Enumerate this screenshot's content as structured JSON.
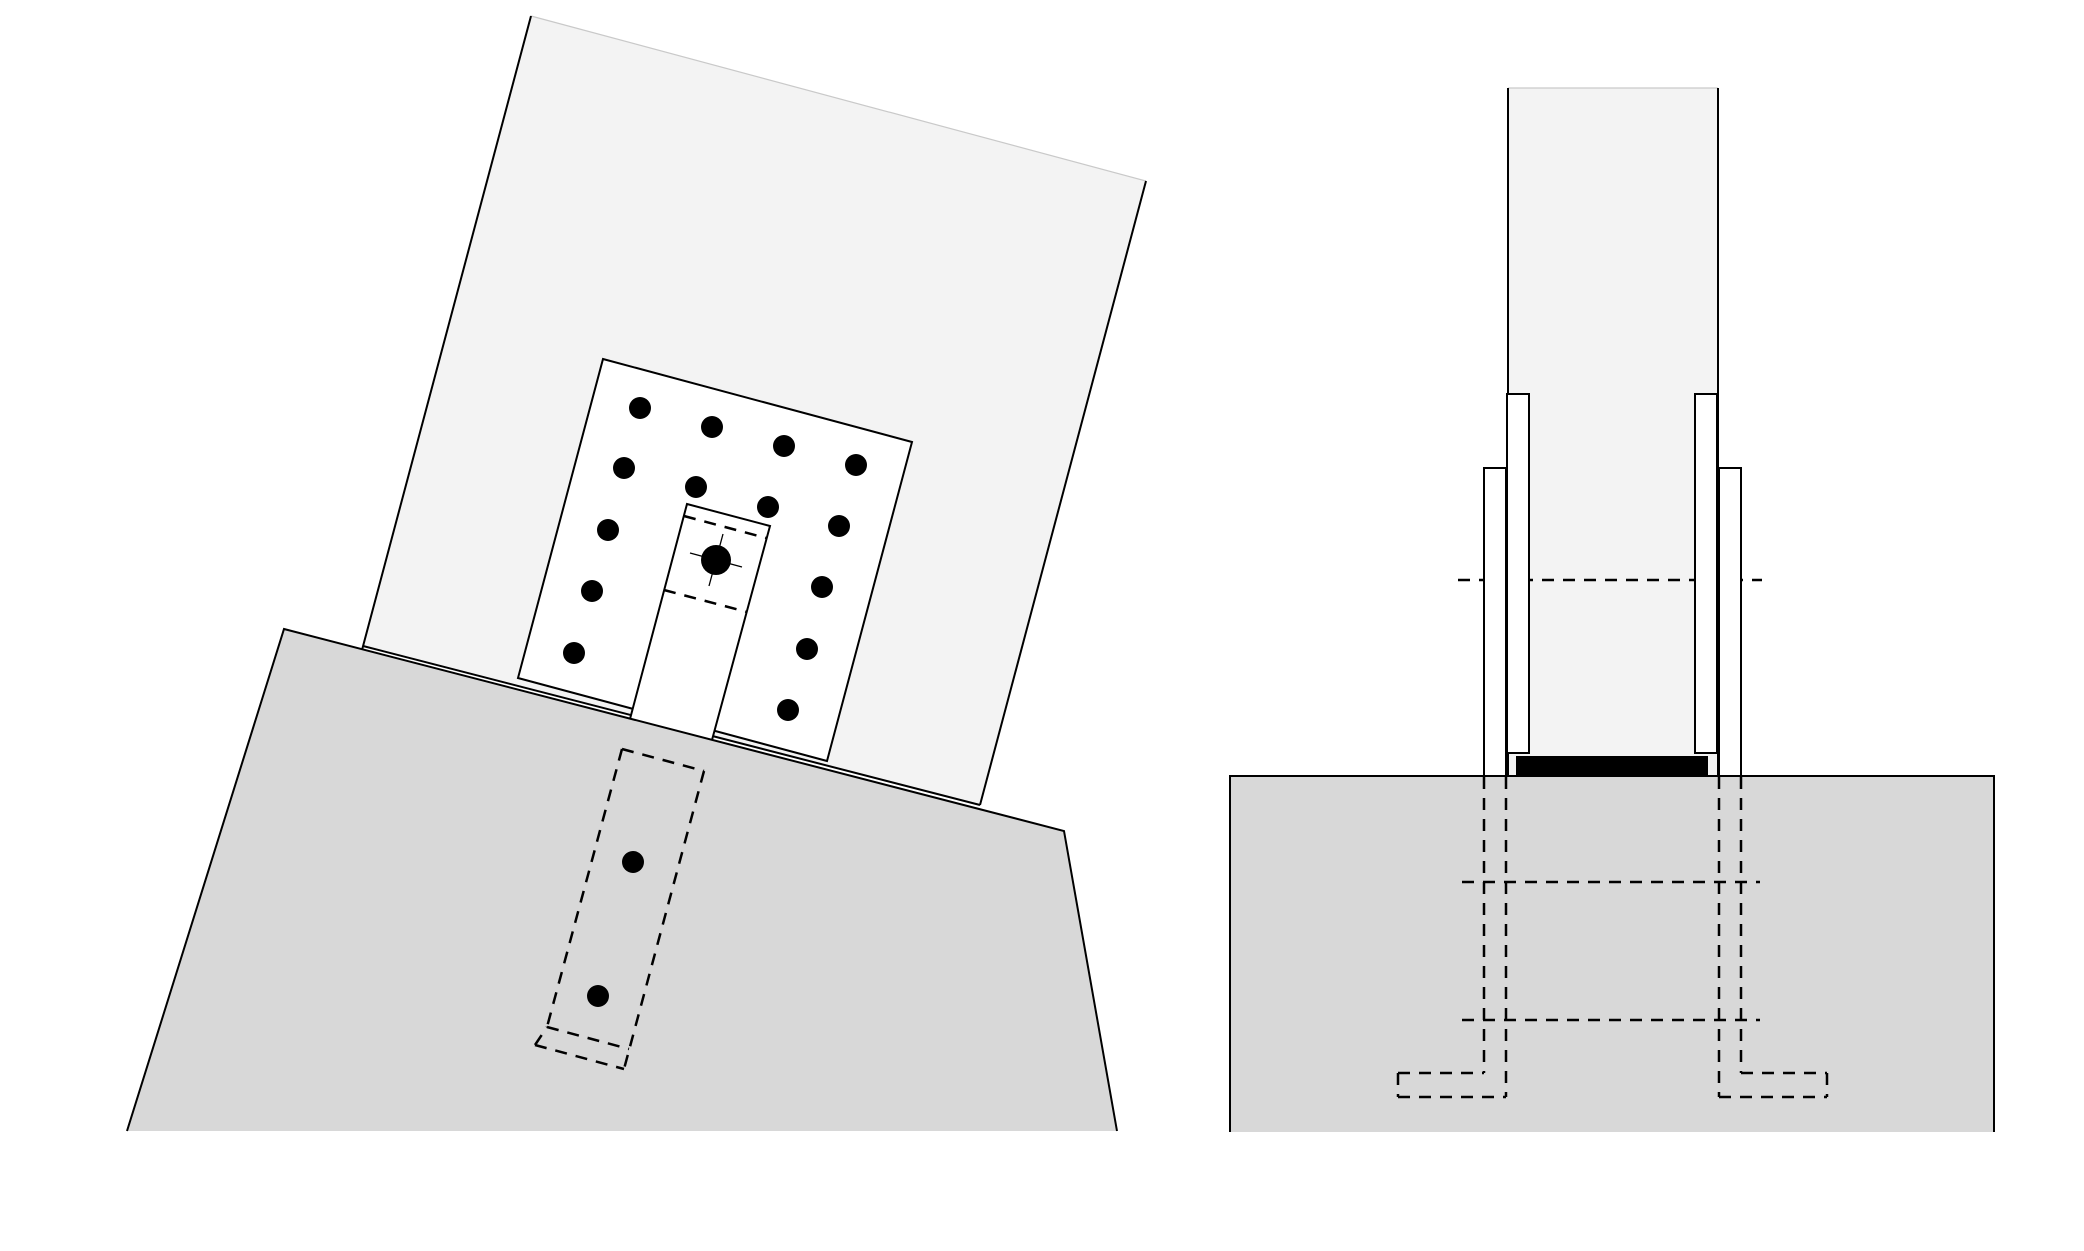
{
  "canvas": {
    "width": 2084,
    "height": 1251,
    "background": "#ffffff"
  },
  "palette": {
    "member_fill": "#f3f3f3",
    "base_fill": "#d8d8d8",
    "plate_fill": "#ffffff",
    "line": "#000000",
    "cut_edge": "#c9c9c9"
  },
  "strokes": {
    "solid_width": 2,
    "dashed_width": 2.5,
    "thin_width": 1.3,
    "cut_width": 1.2,
    "dash_pattern": "12 9"
  },
  "views": [
    {
      "name": "inclined-member-elevation-view",
      "shapes": [
        {
          "type": "polygon",
          "name": "inclined-member-fill",
          "points": [
            [
              531,
              16
            ],
            [
              1146,
              181
            ],
            [
              980,
              805
            ],
            [
              363,
              646
            ]
          ],
          "fill": "#f3f3f3"
        },
        {
          "type": "line",
          "name": "member-cut-top-edge",
          "p": [
            531,
            16,
            1146,
            181
          ],
          "stroke": "#c9c9c9",
          "w": 1.2
        },
        {
          "type": "line",
          "name": "member-left-edge",
          "p": [
            531,
            16,
            362,
            650
          ],
          "stroke": "#000000",
          "w": 2
        },
        {
          "type": "line",
          "name": "member-right-edge",
          "p": [
            1146,
            181,
            980,
            805
          ],
          "stroke": "#000000",
          "w": 2
        },
        {
          "type": "line",
          "name": "member-bottom-edge",
          "p": [
            363,
            646,
            980,
            805
          ],
          "stroke": "#000000",
          "w": 2
        },
        {
          "type": "polygon",
          "name": "connection-plate",
          "points": [
            [
              603,
              359
            ],
            [
              912,
              442
            ],
            [
              827,
              761
            ],
            [
              518,
              678
            ]
          ],
          "fill": "#ffffff",
          "stroke": "#000000",
          "w": 2
        },
        {
          "type": "polygon",
          "name": "center-slot-fill",
          "points": [
            [
              687,
              504
            ],
            [
              770,
              526
            ],
            [
              712,
              740
            ],
            [
              630,
              719
            ]
          ],
          "fill": "#ffffff"
        },
        {
          "type": "polyline",
          "name": "center-slot-outline",
          "points": [
            [
              630,
              719
            ],
            [
              687,
              504
            ],
            [
              770,
              526
            ],
            [
              712,
              740
            ]
          ],
          "stroke": "#000000",
          "w": 2
        },
        {
          "type": "line",
          "name": "slot-hidden-line-upper",
          "p": [
            684,
            516,
            766,
            538
          ],
          "stroke": "#000000",
          "w": 2.5,
          "dash": "12 9"
        },
        {
          "type": "line",
          "name": "slot-hidden-line-lower",
          "p": [
            664,
            590,
            747,
            612
          ],
          "stroke": "#000000",
          "w": 2.5,
          "dash": "12 9"
        },
        {
          "type": "line",
          "name": "main-bolt-centermark-axis-u",
          "p": [
            690,
            553,
            742,
            567
          ],
          "stroke": "#000000",
          "w": 1.3
        },
        {
          "type": "line",
          "name": "main-bolt-centermark-axis-v",
          "p": [
            723,
            534,
            709,
            586
          ],
          "stroke": "#000000",
          "w": 1.3
        },
        {
          "type": "circle",
          "name": "main-bolt-head",
          "c": [
            716,
            560
          ],
          "r": 15,
          "fill": "#000000"
        },
        {
          "type": "circle",
          "name": "plate-bolt-1",
          "c": [
            640,
            408
          ],
          "r": 11,
          "fill": "#000000"
        },
        {
          "type": "circle",
          "name": "plate-bolt-2",
          "c": [
            712,
            427
          ],
          "r": 11,
          "fill": "#000000"
        },
        {
          "type": "circle",
          "name": "plate-bolt-3",
          "c": [
            784,
            446
          ],
          "r": 11,
          "fill": "#000000"
        },
        {
          "type": "circle",
          "name": "plate-bolt-4",
          "c": [
            856,
            465
          ],
          "r": 11,
          "fill": "#000000"
        },
        {
          "type": "circle",
          "name": "plate-bolt-5",
          "c": [
            624,
            468
          ],
          "r": 11,
          "fill": "#000000"
        },
        {
          "type": "circle",
          "name": "plate-bolt-6",
          "c": [
            696,
            487
          ],
          "r": 11,
          "fill": "#000000"
        },
        {
          "type": "circle",
          "name": "plate-bolt-7",
          "c": [
            768,
            507
          ],
          "r": 11,
          "fill": "#000000"
        },
        {
          "type": "circle",
          "name": "plate-bolt-8",
          "c": [
            839,
            526
          ],
          "r": 11,
          "fill": "#000000"
        },
        {
          "type": "circle",
          "name": "plate-bolt-9",
          "c": [
            608,
            530
          ],
          "r": 11,
          "fill": "#000000"
        },
        {
          "type": "circle",
          "name": "plate-bolt-10",
          "c": [
            822,
            587
          ],
          "r": 11,
          "fill": "#000000"
        },
        {
          "type": "circle",
          "name": "plate-bolt-11",
          "c": [
            592,
            591
          ],
          "r": 11,
          "fill": "#000000"
        },
        {
          "type": "circle",
          "name": "plate-bolt-12",
          "c": [
            807,
            649
          ],
          "r": 11,
          "fill": "#000000"
        },
        {
          "type": "circle",
          "name": "plate-bolt-13",
          "c": [
            574,
            653
          ],
          "r": 11,
          "fill": "#000000"
        },
        {
          "type": "circle",
          "name": "plate-bolt-14",
          "c": [
            788,
            710
          ],
          "r": 11,
          "fill": "#000000"
        },
        {
          "type": "polygon",
          "name": "foundation-base-fill",
          "points": [
            [
              284,
              629
            ],
            [
              1064,
              831
            ],
            [
              1117,
              1131
            ],
            [
              127,
              1131
            ]
          ],
          "fill": "#d8d8d8"
        },
        {
          "type": "polyline",
          "name": "foundation-base-outline",
          "points": [
            [
              127,
              1131
            ],
            [
              284,
              629
            ],
            [
              1064,
              831
            ],
            [
              1117,
              1131
            ]
          ],
          "stroke": "#000000",
          "w": 2
        },
        {
          "type": "line",
          "name": "embedded-slot-top-hidden",
          "p": [
            622,
            749,
            704,
            771
          ],
          "stroke": "#000000",
          "w": 2.5,
          "dash": "12 9"
        },
        {
          "type": "line",
          "name": "embedded-slot-left-hidden",
          "p": [
            622,
            749,
            547,
            1027
          ],
          "stroke": "#000000",
          "w": 2.5,
          "dash": "12 9"
        },
        {
          "type": "line",
          "name": "embedded-slot-right-hidden",
          "p": [
            704,
            771,
            624,
            1069
          ],
          "stroke": "#000000",
          "w": 2.5,
          "dash": "12 9"
        },
        {
          "type": "line",
          "name": "embedded-slot-bottom-hidden",
          "p": [
            547,
            1027,
            629,
            1049
          ],
          "stroke": "#000000",
          "w": 2.5,
          "dash": "12 9"
        },
        {
          "type": "line",
          "name": "embedded-foot-bottom-hidden",
          "p": [
            535,
            1045,
            624,
            1069
          ],
          "stroke": "#000000",
          "w": 2.5,
          "dash": "12 9"
        },
        {
          "type": "line",
          "name": "embedded-foot-cap-hidden",
          "p": [
            535,
            1045,
            547,
            1027
          ],
          "stroke": "#000000",
          "w": 2.5,
          "dash": "12 9"
        },
        {
          "type": "circle",
          "name": "anchor-bolt-upper",
          "c": [
            633,
            862
          ],
          "r": 11,
          "fill": "#000000"
        },
        {
          "type": "circle",
          "name": "anchor-bolt-lower",
          "c": [
            598,
            996
          ],
          "r": 11,
          "fill": "#000000"
        }
      ]
    },
    {
      "name": "column-base-front-view",
      "shapes": [
        {
          "type": "rect",
          "name": "column-fill",
          "xywh": [
            1508,
            88,
            210,
            688
          ],
          "fill": "#f3f3f3"
        },
        {
          "type": "line",
          "name": "column-cut-top-edge",
          "p": [
            1508,
            88,
            1718,
            88
          ],
          "stroke": "#c9c9c9",
          "w": 1.2
        },
        {
          "type": "line",
          "name": "column-left-edge",
          "p": [
            1508,
            88,
            1508,
            776
          ],
          "stroke": "#000000",
          "w": 2
        },
        {
          "type": "line",
          "name": "column-right-edge",
          "p": [
            1718,
            88,
            1718,
            776
          ],
          "stroke": "#000000",
          "w": 2
        },
        {
          "type": "line",
          "name": "bolt-axis-hidden-line",
          "p": [
            1458,
            580,
            1762,
            580
          ],
          "stroke": "#000000",
          "w": 2.5,
          "dash": "12 9"
        },
        {
          "type": "rect",
          "name": "inner-side-plate-left",
          "xywh": [
            1507,
            394,
            22,
            359
          ],
          "fill": "#ffffff",
          "stroke": "#000000",
          "w": 2
        },
        {
          "type": "rect",
          "name": "inner-side-plate-right",
          "xywh": [
            1695,
            394,
            22,
            359
          ],
          "fill": "#ffffff",
          "stroke": "#000000",
          "w": 2
        },
        {
          "type": "rect",
          "name": "bearing-pad",
          "xywh": [
            1516,
            756,
            192,
            20
          ],
          "fill": "#000000"
        },
        {
          "type": "rect",
          "name": "outer-side-plate-left",
          "xywh": [
            1484,
            468,
            22,
            309
          ],
          "fill": "#ffffff",
          "stroke": "#000000",
          "w": 2
        },
        {
          "type": "rect",
          "name": "outer-side-plate-right",
          "xywh": [
            1719,
            468,
            22,
            309
          ],
          "fill": "#ffffff",
          "stroke": "#000000",
          "w": 2
        },
        {
          "type": "rect",
          "name": "footing-fill",
          "xywh": [
            1230,
            776,
            764,
            356
          ],
          "fill": "#d8d8d8"
        },
        {
          "type": "polyline",
          "name": "footing-outline",
          "points": [
            [
              1230,
              1132
            ],
            [
              1230,
              776
            ],
            [
              1994,
              776
            ],
            [
              1994,
              1132
            ]
          ],
          "stroke": "#000000",
          "w": 2
        },
        {
          "type": "line",
          "name": "anchor-left-outer-hidden",
          "p": [
            1484,
            777,
            1484,
            1073
          ],
          "stroke": "#000000",
          "w": 2.5,
          "dash": "12 9"
        },
        {
          "type": "line",
          "name": "anchor-left-inner-hidden",
          "p": [
            1506,
            777,
            1506,
            1097
          ],
          "stroke": "#000000",
          "w": 2.5,
          "dash": "12 9"
        },
        {
          "type": "line",
          "name": "anchor-left-foot-top-hidden",
          "p": [
            1398,
            1073,
            1484,
            1073
          ],
          "stroke": "#000000",
          "w": 2.5,
          "dash": "12 9"
        },
        {
          "type": "line",
          "name": "anchor-left-foot-bottom-hidden",
          "p": [
            1398,
            1097,
            1506,
            1097
          ],
          "stroke": "#000000",
          "w": 2.5,
          "dash": "12 9"
        },
        {
          "type": "line",
          "name": "anchor-left-foot-cap-hidden",
          "p": [
            1398,
            1073,
            1398,
            1097
          ],
          "stroke": "#000000",
          "w": 2.5,
          "dash": "12 9"
        },
        {
          "type": "line",
          "name": "anchor-right-outer-hidden",
          "p": [
            1741,
            777,
            1741,
            1073
          ],
          "stroke": "#000000",
          "w": 2.5,
          "dash": "12 9"
        },
        {
          "type": "line",
          "name": "anchor-right-inner-hidden",
          "p": [
            1719,
            777,
            1719,
            1097
          ],
          "stroke": "#000000",
          "w": 2.5,
          "dash": "12 9"
        },
        {
          "type": "line",
          "name": "anchor-right-foot-top-hidden",
          "p": [
            1741,
            1073,
            1827,
            1073
          ],
          "stroke": "#000000",
          "w": 2.5,
          "dash": "12 9"
        },
        {
          "type": "line",
          "name": "anchor-right-foot-bottom-hidden",
          "p": [
            1719,
            1097,
            1827,
            1097
          ],
          "stroke": "#000000",
          "w": 2.5,
          "dash": "12 9"
        },
        {
          "type": "line",
          "name": "anchor-right-foot-cap-hidden",
          "p": [
            1827,
            1073,
            1827,
            1097
          ],
          "stroke": "#000000",
          "w": 2.5,
          "dash": "12 9"
        },
        {
          "type": "line",
          "name": "cross-rod-upper-hidden",
          "p": [
            1462,
            882,
            1760,
            882
          ],
          "stroke": "#000000",
          "w": 2.5,
          "dash": "12 9"
        },
        {
          "type": "line",
          "name": "cross-rod-lower-hidden",
          "p": [
            1462,
            1020,
            1760,
            1020
          ],
          "stroke": "#000000",
          "w": 2.5,
          "dash": "12 9"
        }
      ]
    }
  ]
}
